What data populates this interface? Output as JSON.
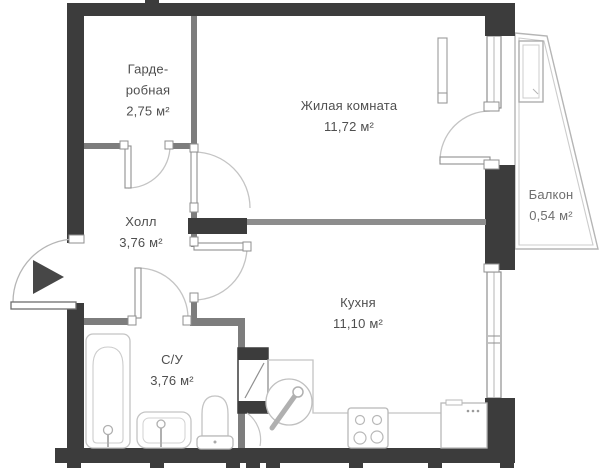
{
  "rooms": {
    "wardrobe": {
      "name_l1": "Гарде-",
      "name_l2": "робная",
      "area": "2,75 м²"
    },
    "living": {
      "name": "Жилая комната",
      "area": "11,72 м²"
    },
    "hall": {
      "name": "Холл",
      "area": "3,76 м²"
    },
    "bathroom": {
      "name": "С/У",
      "area": "3,76 м²"
    },
    "kitchen": {
      "name": "Кухня",
      "area": "11,10 м²"
    },
    "balcony": {
      "name": "Балкон",
      "area": "0,54 м²"
    }
  },
  "colors": {
    "outer_wall": "#3c3c3c",
    "inner_wall": "#7d7d7d",
    "thin_line": "#c4c4c4",
    "label_text": "#4f4f4f",
    "entrance_arrow": "#474747"
  }
}
